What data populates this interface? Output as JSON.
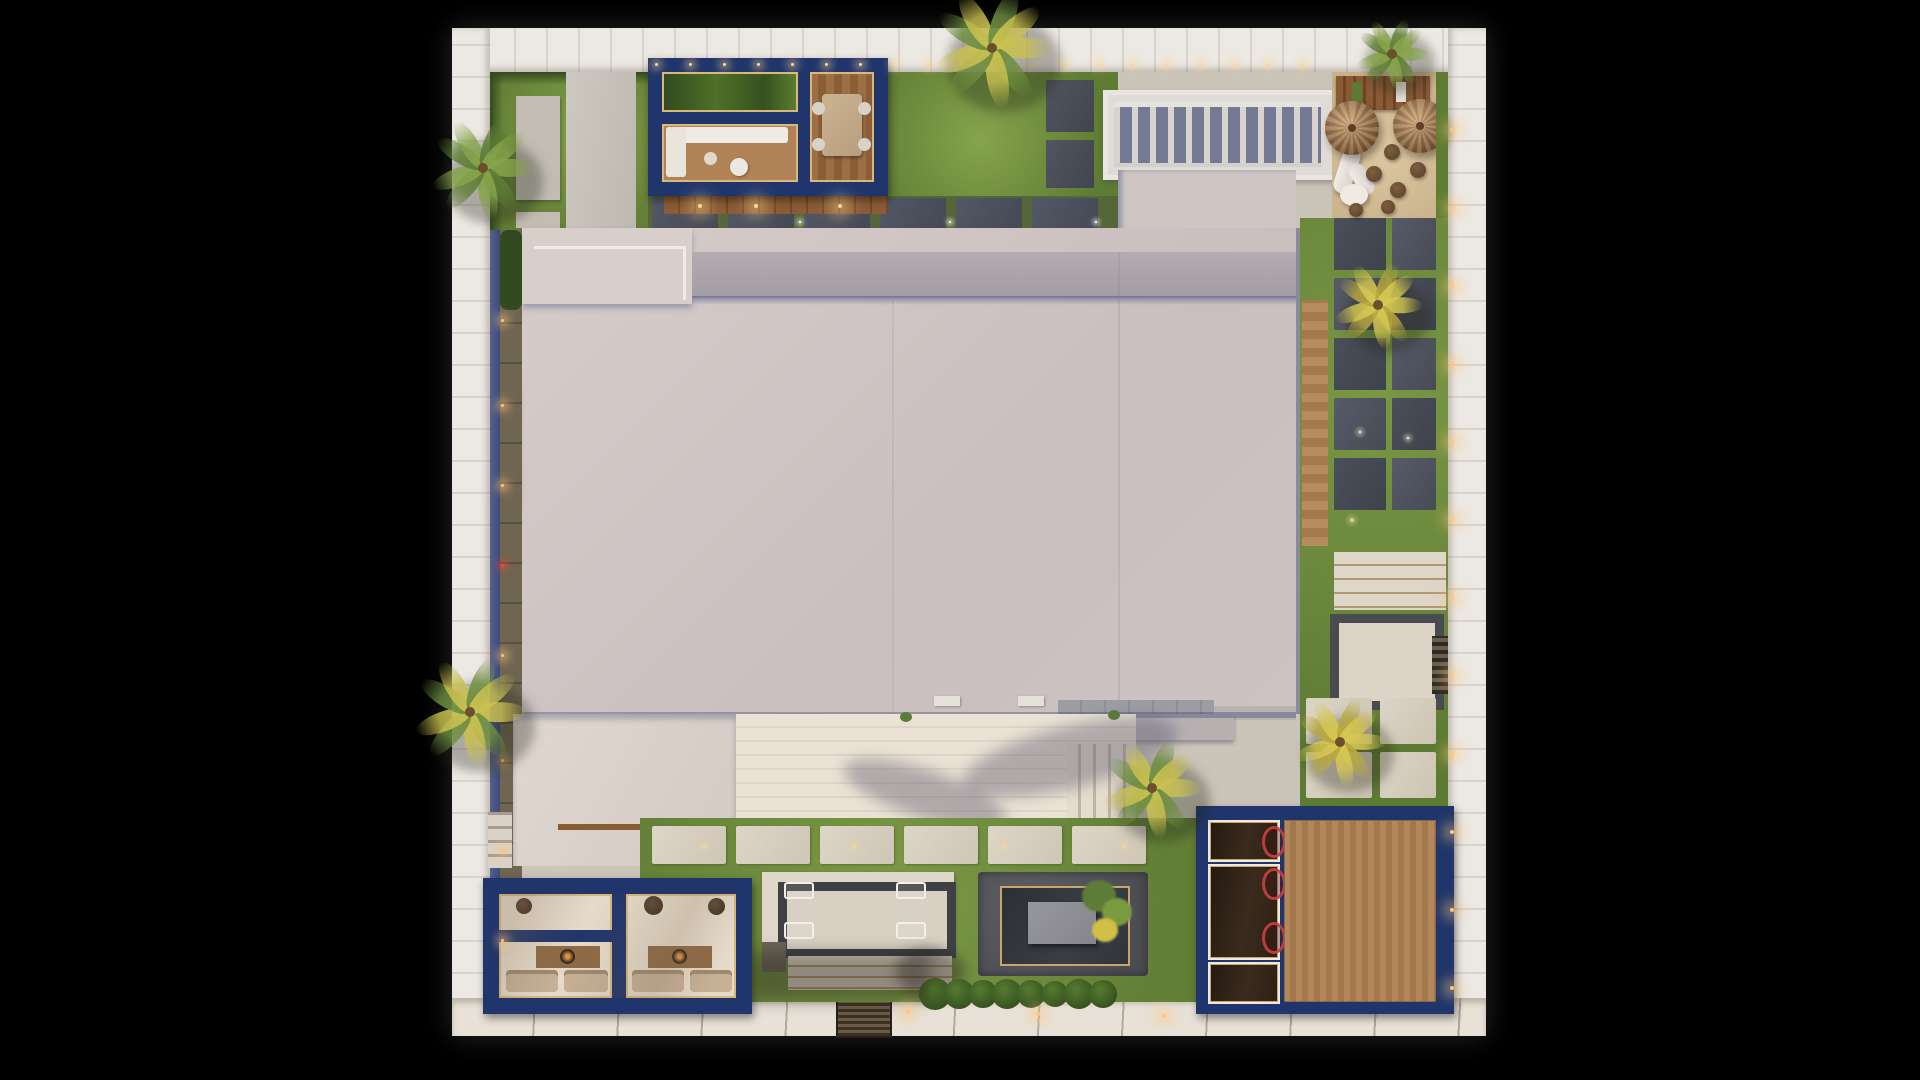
{
  "scene": {
    "description": "Aerial top-down 3D architectural render of a modern villa plot at dusk: white plank boundary walls with string lights, central flat-roof house, two navy-framed pavilions, garage block with wood deck, playground, pool lounge, reflecting water feature, lawns, paver paths and palm trees on a black backdrop",
    "background": "#000000",
    "mat": "#f5f2ee"
  },
  "colors": {
    "navy": "#20356b",
    "navyDark": "#182a55",
    "lawn": "#76933f",
    "lawnDark": "#5c7a33",
    "roof": "#cfc6c4",
    "roofLight": "#d8cfcc",
    "parapet": "#a8a1a8",
    "shadowBlue": "#7d80a3",
    "slate": "#4a4e5a",
    "ivory": "#e8e0d2",
    "paver": "#d6cec0",
    "wood": "#a87c50",
    "woodDark": "#7b4f2b",
    "deck": "#ae835a",
    "sand": "#d5bf98",
    "water": "#31353b",
    "pebble": "#55565b",
    "gold": "#c9a56b",
    "glow": "#ffd793",
    "concrete": "#c2bcb2",
    "gravel": "#c9c4bd",
    "wallPlank": "#ece8e3",
    "wallJoint": "#d9d3cd",
    "shrub": "#3c5424"
  },
  "palms": [
    {
      "x": 483,
      "y": 168,
      "r": 54,
      "tone": "green"
    },
    {
      "x": 470,
      "y": 712,
      "r": 58,
      "tone": "mix"
    },
    {
      "x": 992,
      "y": 48,
      "r": 62,
      "tone": "mix"
    },
    {
      "x": 1392,
      "y": 54,
      "r": 38,
      "tone": "green"
    },
    {
      "x": 1378,
      "y": 305,
      "r": 46,
      "tone": "yellow"
    },
    {
      "x": 1340,
      "y": 742,
      "r": 48,
      "tone": "yellow"
    },
    {
      "x": 1152,
      "y": 788,
      "r": 52,
      "tone": "mix"
    }
  ],
  "light_rows": [
    {
      "name": "top-string-lights",
      "axis": "x",
      "from": 656,
      "to": 1332,
      "step": 34,
      "fixed": 64,
      "size": 3,
      "glow": 9,
      "color": "#ffd793"
    },
    {
      "name": "right-wall-lights",
      "axis": "y",
      "from": 130,
      "to": 995,
      "step": 78,
      "fixed": 1452,
      "size": 4,
      "glow": 14,
      "color": "#ffc878"
    }
  ],
  "light_points": [
    {
      "name": "bottom-wall-lights",
      "pts": [
        [
          908,
          1012
        ],
        [
          1038,
          1014
        ],
        [
          1164,
          1016
        ]
      ],
      "size": 4,
      "glow": 13,
      "color": "#ffc878"
    },
    {
      "name": "side-yard-lights",
      "pts": [
        [
          502,
          320
        ],
        [
          502,
          405
        ],
        [
          502,
          485
        ],
        [
          502,
          655
        ],
        [
          502,
          760
        ],
        [
          502,
          850
        ],
        [
          502,
          940
        ]
      ],
      "size": 3,
      "glow": 10,
      "color": "#ffc27a"
    },
    {
      "name": "side-yard-red-light",
      "pts": [
        [
          502,
          565
        ]
      ],
      "size": 3,
      "glow": 8,
      "color": "#ff4433"
    },
    {
      "name": "patio-slab-lights",
      "pts": [
        [
          800,
          222
        ],
        [
          950,
          222
        ],
        [
          1096,
          222
        ]
      ],
      "size": 2,
      "glow": 5,
      "color": "#ffffff"
    },
    {
      "name": "walkway-lights",
      "pts": [
        [
          704,
          846
        ],
        [
          854,
          846
        ],
        [
          1004,
          846
        ],
        [
          1124,
          846
        ]
      ],
      "size": 2,
      "glow": 6,
      "color": "#ffd98e"
    },
    {
      "name": "corridor-lights",
      "pts": [
        [
          1360,
          432
        ],
        [
          1408,
          438
        ],
        [
          1352,
          520
        ]
      ],
      "size": 2,
      "glow": 5,
      "color": "#fff2cc"
    },
    {
      "name": "pavilion-deck-lights",
      "pts": [
        [
          700,
          206
        ],
        [
          756,
          206
        ],
        [
          840,
          206
        ]
      ],
      "size": 4,
      "glow": 16,
      "color": "#ffd793"
    }
  ],
  "slate_band": {
    "x": 652,
    "y": 198,
    "w": 66,
    "h": 48,
    "gap": 10,
    "count": 6
  },
  "top_right_slabs": [
    [
      1046,
      80,
      48,
      52
    ],
    [
      1046,
      140,
      48,
      48
    ]
  ],
  "corridor_grid": {
    "cols": [
      {
        "x": 1334,
        "w": 52
      },
      {
        "x": 1392,
        "w": 44
      }
    ],
    "y": 218,
    "h": 52,
    "gap": 8,
    "count": 5
  },
  "walkway_row": {
    "x": 652,
    "y": 826,
    "w": 74,
    "h": 38,
    "gap": 10,
    "count": 6
  },
  "lower_pads": [
    [
      1306,
      698,
      66,
      46
    ],
    [
      1380,
      698,
      56,
      46
    ],
    [
      1306,
      752,
      66,
      46
    ],
    [
      1380,
      752,
      56,
      46
    ]
  ],
  "hedge": {
    "from": 935,
    "to": 1120,
    "step": 24,
    "y": 994,
    "r": 13
  },
  "play": {
    "umbrellas": [
      [
        1352,
        128,
        27
      ],
      [
        1420,
        126,
        27
      ]
    ],
    "circles": [
      [
        1392,
        152,
        8
      ],
      [
        1374,
        174,
        8
      ],
      [
        1398,
        190,
        8
      ],
      [
        1418,
        170,
        8
      ],
      [
        1388,
        207,
        7
      ],
      [
        1356,
        210,
        7
      ]
    ]
  },
  "pool_loungers": [
    [
      784,
      882
    ],
    [
      896,
      882
    ],
    [
      784,
      922
    ],
    [
      896,
      922
    ]
  ],
  "garage": {
    "cells": [
      {
        "x": 1208,
        "y": 820,
        "w": 68,
        "h": 38
      },
      {
        "x": 1208,
        "y": 864,
        "w": 68,
        "h": 92
      },
      {
        "x": 1208,
        "y": 962,
        "w": 68,
        "h": 38
      }
    ],
    "cars": [
      {
        "cell": 0,
        "top": 6
      },
      {
        "cell": 1,
        "top": 4
      },
      {
        "cell": 1,
        "top": 58
      }
    ]
  },
  "terrace_shadows": [
    {
      "x": 960,
      "y": 726,
      "w": 220,
      "h": 62,
      "rot": -14
    },
    {
      "x": 840,
      "y": 770,
      "w": 170,
      "h": 48,
      "rot": 18
    }
  ]
}
